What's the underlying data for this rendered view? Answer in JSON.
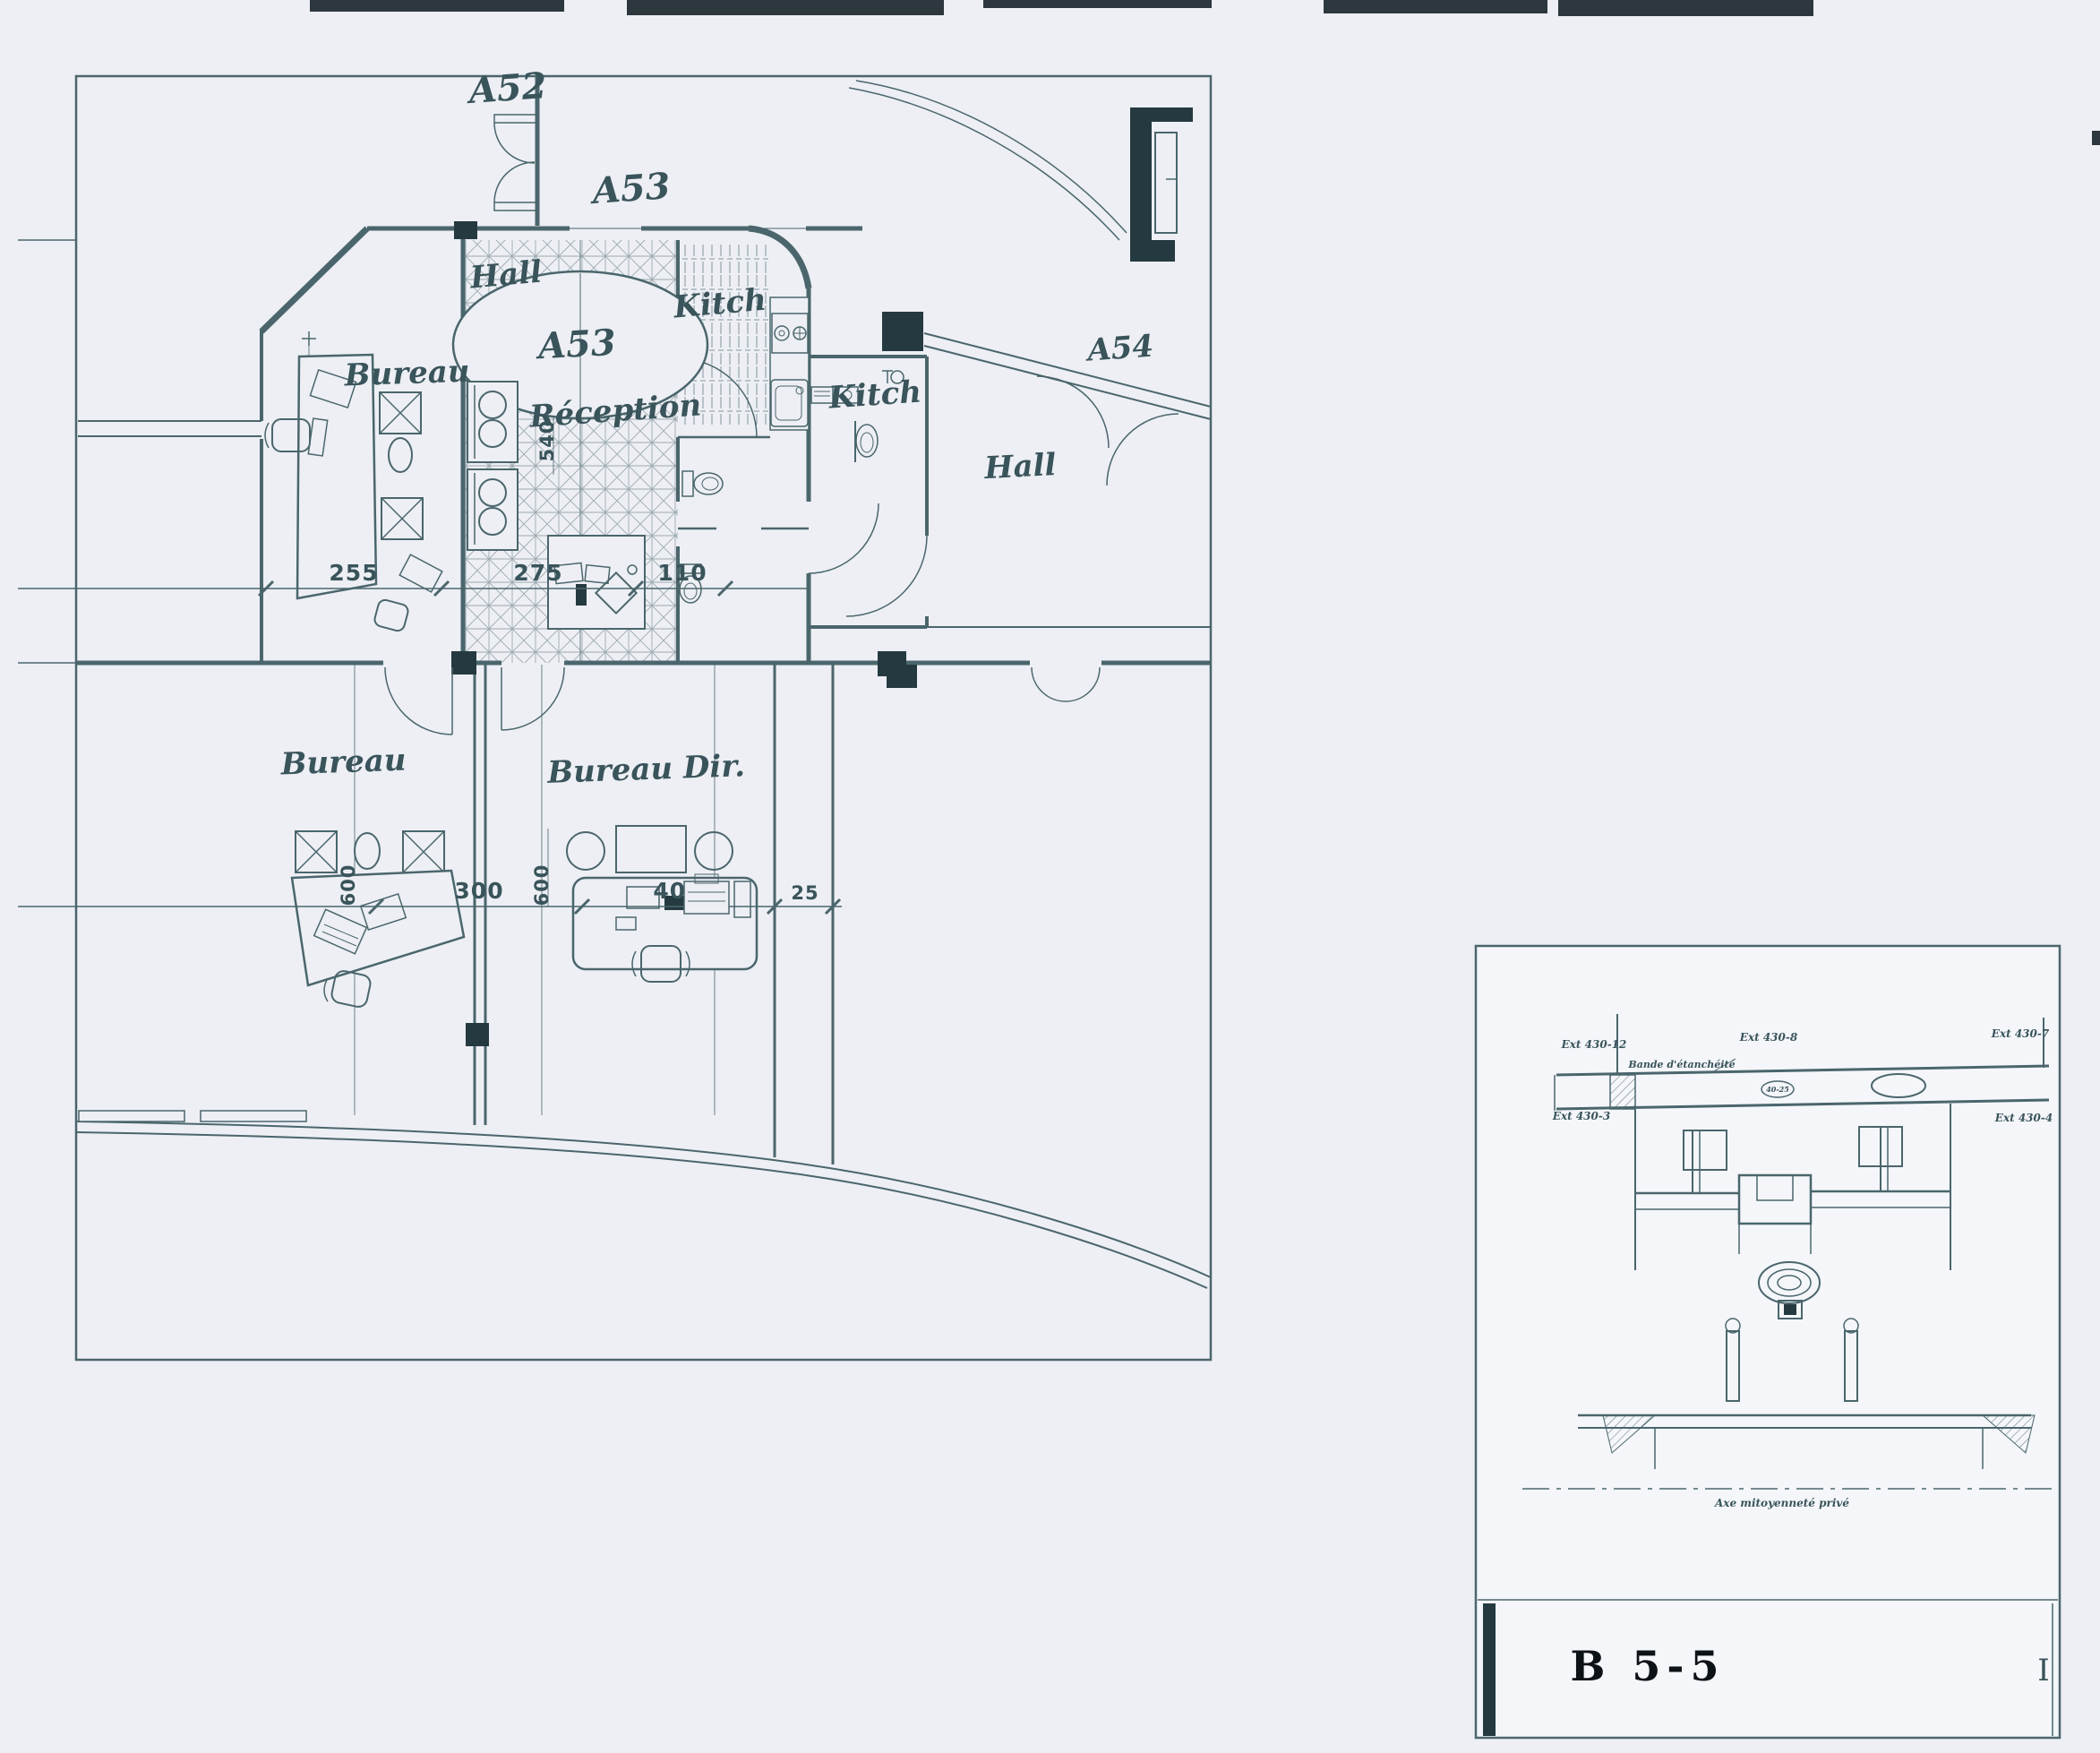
{
  "colors": {
    "paper": "#edeff4",
    "inset-paper": "#f4f6fa",
    "ink": "#4a666c",
    "ink-strong": "#39545a",
    "dark": "#243a40",
    "title": "#0d1216",
    "smudge": "#17242a"
  },
  "plan": {
    "labels": {
      "a52": "A52",
      "a53_top": "A53",
      "a53_room": "A53",
      "a54": "A54",
      "hall_main": "Hall",
      "hall_right": "Hall",
      "kitch_left": "Kitch",
      "kitch_right": "Kitch",
      "reception": "Réception",
      "bureau_top": "Bureau",
      "bureau_bottom": "Bureau",
      "bureau_dir": "Bureau Dir."
    },
    "dimensions": {
      "d255": "255",
      "d275": "275",
      "d110": "110",
      "d540": "540",
      "d300": "300",
      "d400": "400",
      "d25": "25",
      "d600_left": "600",
      "d600_right": "600"
    }
  },
  "inset": {
    "title": "B 5-5",
    "margin_mark": "I",
    "annotations": {
      "ext_top_left": "Ext 430-12",
      "ext_top_mid": "Ext 430-8",
      "ext_top_right": "Ext 430-7",
      "ext_bottom_left": "Ext 430-3",
      "ext_bottom_right": "Ext 430-4",
      "membrane": "Bande d'étanchéité",
      "oval_mark": "40-25",
      "axis": "Axe mitoyenneté privé"
    }
  }
}
